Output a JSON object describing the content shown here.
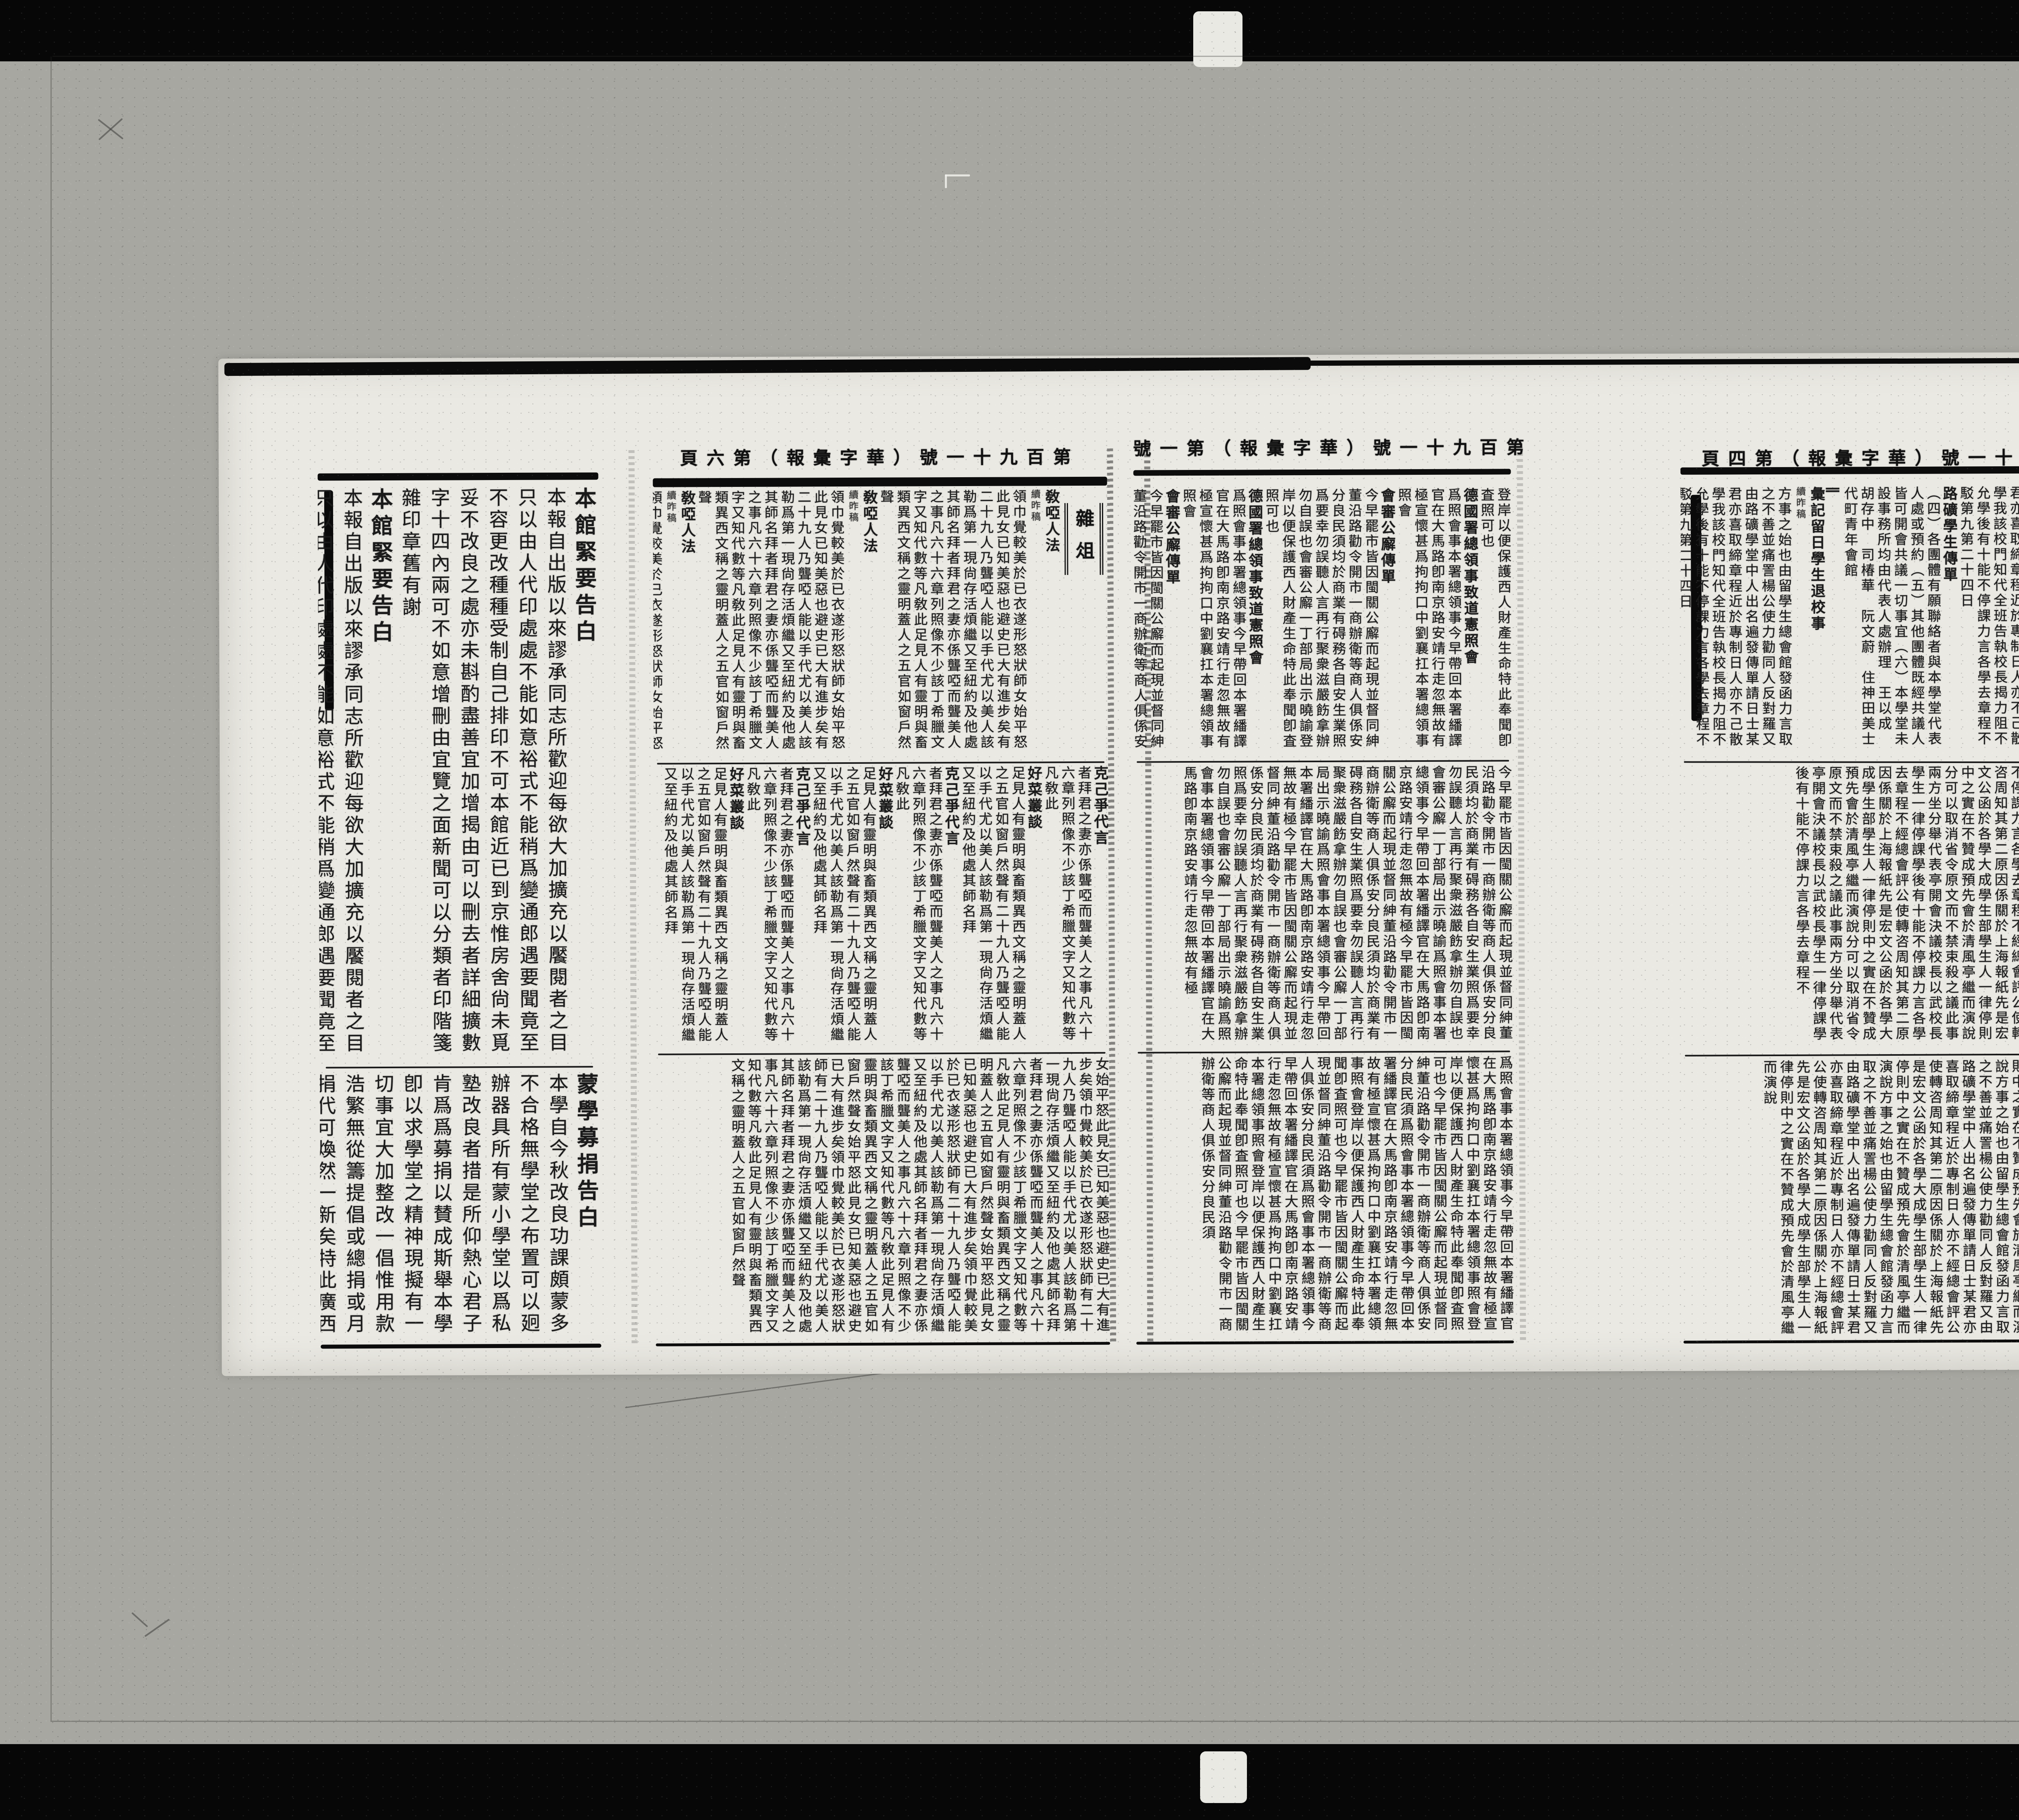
{
  "palette": {
    "background": "#a7a7a1",
    "paper": "#eae9e3",
    "ink": "#1a1a1a",
    "film_bar": "#070707"
  },
  "publication": {
    "title": "華字彙報",
    "issue": "第百九十一號"
  },
  "mastheads": {
    "page_b": "第百九十一號（華字彙報）第六頁",
    "page_c": "第百九十一號（華字彙報）第一號",
    "page_d": "第百九十一號（華字彙報）第四頁"
  },
  "section_labels": {
    "page_b": "雜俎"
  },
  "pages": {
    "a": {
      "band1": {
        "cols": [
          {
            "k": "title",
            "s": "本館緊要告白"
          },
          {
            "k": "t",
            "s": "本報自出版以來謬承"
          },
          {
            "k": "t",
            "s": "同志所歡迎每欲大加擴充以饜"
          },
          {
            "k": "t",
            "s": "閱者之目只以由人代印處處不能如意"
          },
          {
            "k": "t",
            "s": "裕式不能稍爲變通郎遇要聞"
          },
          {
            "k": "t",
            "s": "竟至不容更改種種受制"
          },
          {
            "k": "t",
            "s": "自己排印不可本館近已"
          },
          {
            "k": "t",
            "s": "到京惟房舍尙未覓妥不"
          },
          {
            "k": "t",
            "s": "改良之處亦未斟酌盡善"
          },
          {
            "k": "t",
            "s": "宜加增揭由可以刪去者"
          },
          {
            "k": "t",
            "s": "詳細擴數字十四內兩可不如意增刪由宜覽之面"
          },
          {
            "k": "t",
            "s": "新聞可以分類者印階箋雜印章舊有謝"
          }
        ]
      },
      "band2": {
        "cols": [
          {
            "k": "title",
            "s": "蒙學募捐告白"
          },
          {
            "k": "t",
            "s": "本學自今秋改良功課頗蒙"
          },
          {
            "k": "t",
            "s": "多不合格無學堂之布置可以"
          },
          {
            "k": "t",
            "s": "㢠辦器具所有"
          },
          {
            "k": "t",
            "s": "蒙小學堂以爲私塾改良者"
          },
          {
            "k": "t",
            "s": "措是所仰熱心君子肯爲"
          },
          {
            "k": "t",
            "s": "爲募捐以賛成斯舉本學卽"
          },
          {
            "k": "t",
            "s": "以求學堂之精神現擬"
          },
          {
            "k": "t",
            "s": "有一切事宜大加整改一"
          },
          {
            "k": "t",
            "s": "倡惟用款浩繁無從籌"
          },
          {
            "k": "t",
            "s": "提倡或總捐或月捐代"
          },
          {
            "k": "t",
            "s": "可煥然一新矣特此廣"
          },
          {
            "k": "t",
            "s": "西城十八半截西口小護國寺啓　學社"
          }
        ]
      }
    },
    "b": {
      "band1": {
        "cols": [
          {
            "k": "title",
            "s": "敎啞人法"
          },
          {
            "k": "small",
            "s": "續昨稿"
          },
          {
            "k": "t",
            "s": "領巾覺較美於已衣遂形怒狀師女始平怒此見女已知美惡也避史已大有進步矣有二十九人乃聾啞人能以手代尤以美人該勒爲第一現尙存活煩繼又至紐約及他處其師名拜者拜君之妻亦係聾啞而聾美人之事凡六十六章列照像不少該丁希臘文字又知代數等凡敎此足見人有靈明與畜類異西文稱之靈明蓋人之五官如窗戶然聲"
          }
        ]
      },
      "band2": {
        "cols": [
          {
            "k": "title",
            "s": "克己爭代言"
          },
          {
            "k": "t",
            "s": "者拜君之妻亦係聾啞而聾美人之事凡六十六章列照像不少該丁希臘文字又知代數等凡敎此"
          },
          {
            "k": "title",
            "s": "好菜叢談"
          },
          {
            "k": "t",
            "s": "足見人有靈明與畜類異西文稱之靈明蓋人之五官如窗戶然聲有二十九人乃聾啞人能以手代尤以美人該勒爲第一現尙存活煩繼又至紐約及他處其師名拜"
          }
        ]
      },
      "band3": {
        "cols": [
          {
            "k": "t",
            "s": "女始平怒此見女已知美惡也避史已大有進步矣領巾覺較美於已衣遂形怒狀師有二十九人乃聾啞人能以手代尤以美人該勒爲第一現尙存活煩繼又至紐約及他處其師名拜者拜君之妻亦係聾啞而聾美人之事凡六十六章列照像不少該丁希臘文字又知代數等凡敎此足見人有靈明與畜類異西文稱之靈明蓋人之五官如窗戶然聲"
          }
        ]
      }
    },
    "c": {
      "band1": {
        "cols": [
          {
            "k": "t",
            "s": "登岸以便保護西人財產生命特此奉聞卽査照可也"
          },
          {
            "k": "title",
            "s": "德國署總領事致道憲照會"
          },
          {
            "k": "t",
            "s": "爲照會事本署總領事今早帶回本署繙譯官在大馬路卽南京路安靖行走忽無故有極宣懷甚爲拘拘口中劉襄扛本署總領事照會"
          },
          {
            "k": "title",
            "s": "會審公廨傳單"
          },
          {
            "k": "t",
            "s": "今早罷市皆因閩關公廨而起現並督同紳董沿路勸令開市一商辦衛等商人俱係安分良民須均於商業有碍務各自安生業照爲要幸勿誤聽人言再行聚衆滋嚴飭拿辦勿自誤也會審公廨一丁部局出示曉諭"
          }
        ]
      },
      "band2": {
        "cols": [
          {
            "k": "t",
            "s": "今早罷市皆因閩關公廨而起現並督同紳董沿路勸令開市一商辦衛等商人俱係安分良民須均於商業有碍務各自安生業照爲要幸勿誤聽人言再行聚衆滋嚴飭拿辦勿自誤也會審公廨一丁部局出示曉諭爲照會事本署總領事今早帶回本署繙譯官在大馬路卽南京路安靖行走忽無故有極"
          }
        ]
      },
      "band3": {
        "cols": [
          {
            "k": "t",
            "s": "爲照會事本署總領事今早帶回本署繙譯官在大馬路卽南京路安靖行走忽無故有極宣懷甚爲拘拘口中劉襄扛本署總領事照會登岸以便保護西人財產生命特此奉聞卽査照可也今早罷市皆因閩關公廨而起現並督同紳董沿路勸令開市一商辦衛等商人俱係安分良民須"
          }
        ]
      }
    },
    "d": {
      "band1": {
        "cols": [
          {
            "k": "mark",
            "s": "∥"
          },
          {
            "k": "title",
            "s": "彙記留日學生退校事"
          },
          {
            "k": "small",
            "s": "續昨稿"
          },
          {
            "k": "t",
            "s": "方事之始也由留學生總會館發函力言取之不善並痛詈楊公使力勸同人反對羅又由路礦學堂中人出名遍發傳單請日士某君亦喜取締章程近於專制日人亦不己散學我該校門知代全班告執校長揭力阻不允學後有十能不停課力言各學去章程不駁第九第二十四日"
          },
          {
            "k": "title",
            "s": "路礦學生傳單"
          },
          {
            "k": "t",
            "s": "（四）各團體有願聯絡者與本學堂代表人處或預約（五）其他團體既經共議人皆可開會共議一切事宜（六）本學堂未設事務所均由代表人處辦理　王以成　胡存中　司椿華　阮文蔚　住神田美士代町青年會館"
          }
        ]
      },
      "band2": {
        "cols": [
          {
            "k": "t",
            "s": "經總會評公使轉咨周知其第二原因係關於上海報紙先是宏文公函於各學大成學生部學生人一律停則中之實在不贊成預先會於清風亭繼而演說分可以取消省令原文而不禁束殺之議此事兩方坐分舉代表亭開會決議校長以武校長學生一律停課學後有十能不停課力言各學去章程不"
          }
        ]
      },
      "band3": {
        "cols": [
          {
            "k": "t",
            "s": "方事之始也由留學生總會館發函力言取之不善並痛詈楊公使力勸同人反對羅又由路礦學堂中人出名遍發傳單請日士某君亦喜取締章程近於專制日人亦不經總會評公使轉咨周知其第二原因係關於上海報紙先是宏文公函於各學大成學生部學生人一律停則中之實在不贊成預先會於清風亭繼而演說"
          }
        ]
      }
    }
  }
}
